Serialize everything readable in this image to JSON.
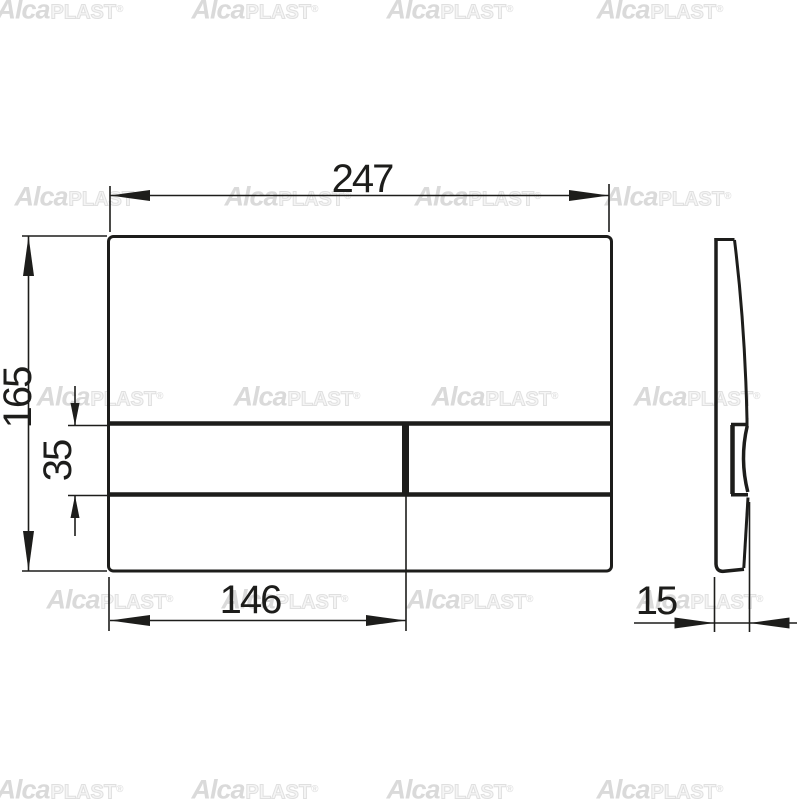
{
  "canvas": {
    "background_color": "#ffffff",
    "line_color": "#1d1d1b"
  },
  "dimensions": {
    "overall_width": "247",
    "overall_height": "165",
    "button_row_height": "35",
    "button_row_width": "146",
    "plate_depth": "15"
  },
  "watermark": {
    "brand_primary": "Alca",
    "brand_secondary": "PLAST",
    "registered_mark": "®",
    "color_primary": "#dadada",
    "color_secondary": "#e0e0e0"
  }
}
